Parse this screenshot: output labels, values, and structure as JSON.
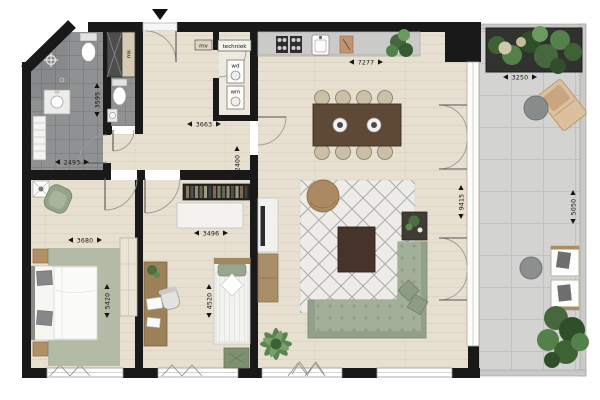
{
  "plan": {
    "type": "apartment-floor-plan",
    "labels": {
      "mv": "mv",
      "techniek": "techniek",
      "wd": "wd",
      "wm": "wm",
      "mk": "mk"
    },
    "dimensions": {
      "living_width": "7277",
      "living_depth": "9415",
      "balcony_width": "3250",
      "balcony_depth": "5050",
      "hall_width": "3663",
      "hall_depth": "2400",
      "bathroom_width": "2493",
      "bathroom_depth": "3595",
      "bedroom_main_width": "3680",
      "bedroom_main_depth": "5420",
      "bedroom2_width": "3496",
      "bedroom2_depth": "4520"
    },
    "colors": {
      "wall": "#191919",
      "wood_floor": "#e7e0d1",
      "bathroom_tile": "#8f9192",
      "balcony_tile": "#d3d4d1",
      "sofa": "#a3b099",
      "rug_living": "#edece8",
      "rug_bedroom": "#b3bba6",
      "dining_table": "#5e4836",
      "coffee_table": "#46342a",
      "pouf": "#ab8a61",
      "plant": "#4e7a43",
      "planter": "#31312f"
    }
  }
}
